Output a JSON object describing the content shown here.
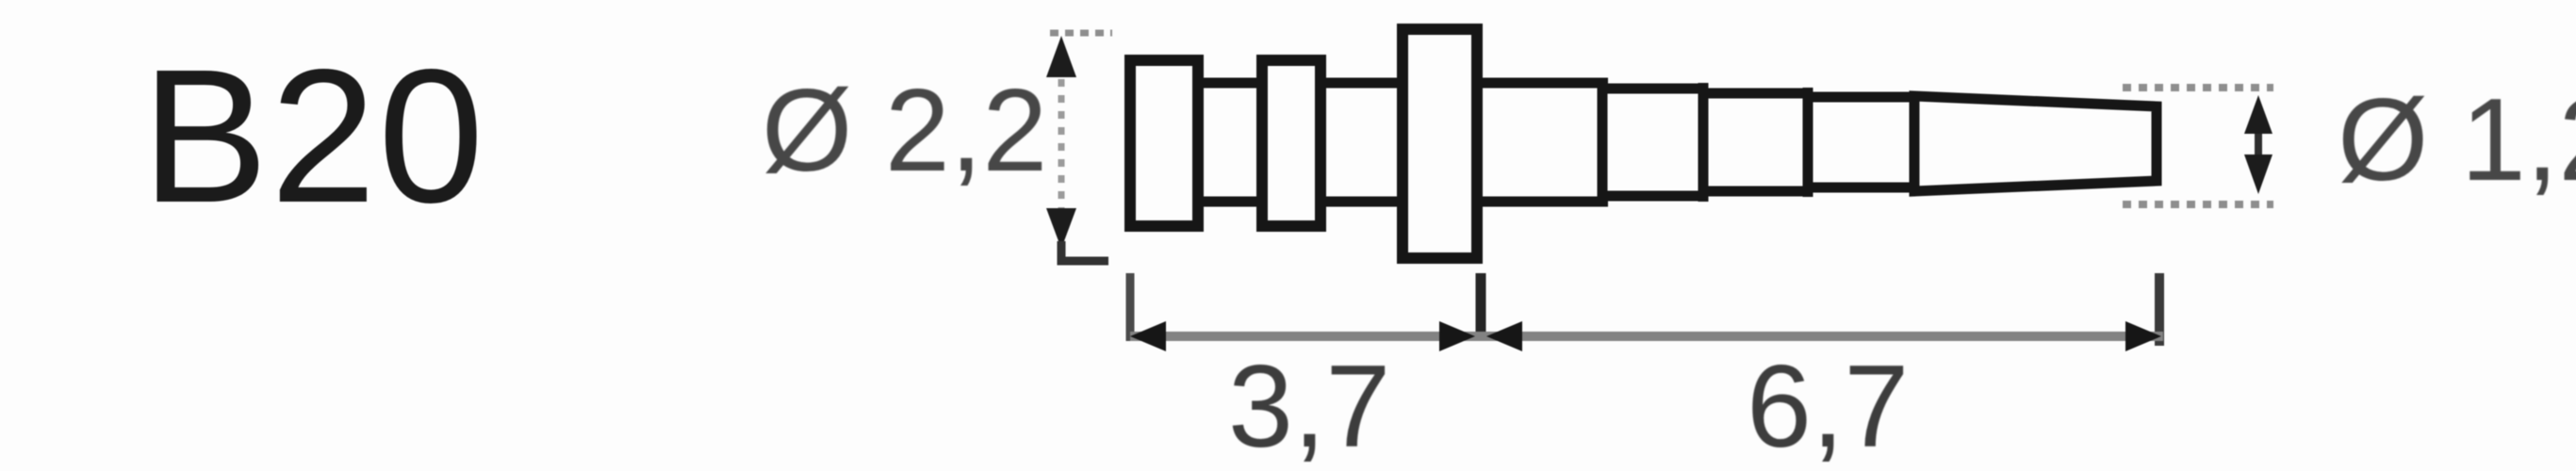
{
  "figure": {
    "part_code": "B20",
    "type_note": "technical dimension drawing of bur shank",
    "dimensions": {
      "diameter_main": "Ø 2,2",
      "diameter_tip": "Ø 1,2",
      "length_shank": "3,7",
      "length_taper": "6,7"
    },
    "colors": {
      "background": "#fdfdfd",
      "outline": "#161616",
      "dimension_line": "#828282",
      "dimension_text": "#474747",
      "part_code_text": "#1b1b1b"
    }
  }
}
